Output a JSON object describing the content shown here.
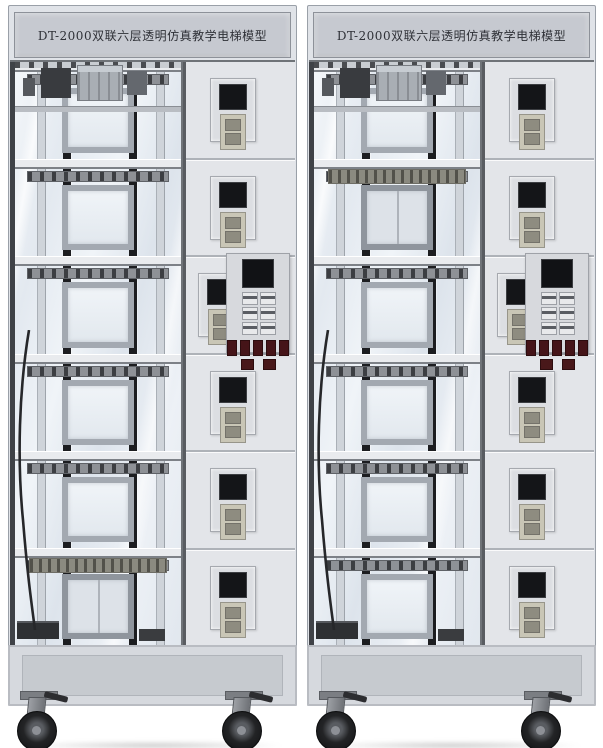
{
  "scene": {
    "background_color": "#ffffff"
  },
  "structure": {
    "floors": 6,
    "cop_panel_floor_from_top": 3,
    "hall_panel": {
      "display": "floor-indicator-lcd",
      "button_slots": 2
    },
    "cop_panel": {
      "display": "floor-indicator-lcd",
      "grid_buttons": 6,
      "red_buttons_row1": 5,
      "red_buttons_row2": 2
    }
  },
  "units": [
    {
      "id": "left-elevator-model",
      "title": "DT-2000双联六层透明仿真教学电梯模型",
      "car_floor_from_top": 6,
      "casters": 2
    },
    {
      "id": "right-elevator-model",
      "title": "DT-2000双联六层透明仿真教学电梯模型",
      "car_floor_from_top": 2,
      "casters": 2
    }
  ],
  "colors": {
    "cabinet": "#e0e3e8",
    "title_plate": "#c6c9d0",
    "title_text": "#2e3036",
    "frame_dark": "#3f4247",
    "guide_rail": "#1c1d20",
    "glass": "#e8edf3",
    "display_black": "#141518",
    "button_red": "#451418",
    "base_panel": "#d6d9de",
    "wheel_black": "#232426"
  }
}
